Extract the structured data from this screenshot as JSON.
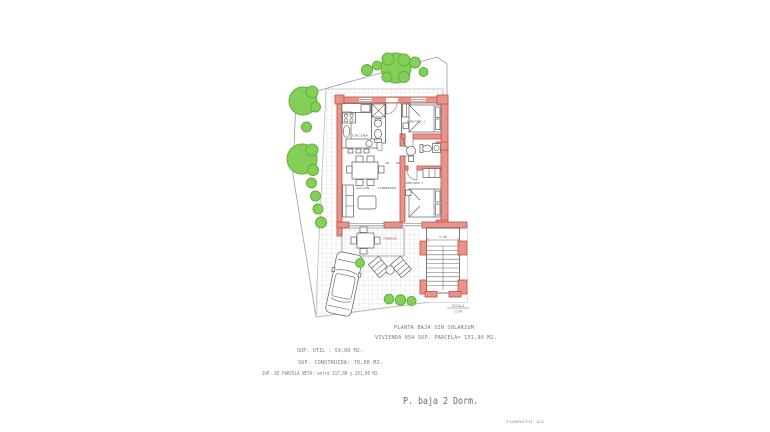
{
  "theme": {
    "wall-fill": "#e8948b",
    "wall-stroke": "#bf4f44",
    "tree-fill": "#85cf58",
    "tree-stroke": "#5fb23a",
    "grid-line": "#cfcfcf"
  },
  "annotations": {
    "title_line1": "PLANTA BAJA SIN SOLARIUM",
    "title_line2": "VIVIENDA 054 SUP. PARCELA= 151,90 M2.",
    "sup_util": "SUP. UTIL : 59,00 M2.",
    "sup_construida": "SUP. CONSTRUIDA: 70,00 M2.",
    "sup_parcela_neta": "SUP. DE PARCELA NETA: entre 117,00 y 201,00 M2.",
    "plate_label": "P. baja 2 Dorm.",
    "sheet_code": "FORMATO A3",
    "scale_label": "ESCALA",
    "scale_value": "1/50",
    "stairs_dim": "4,00"
  },
  "room_labels": {
    "kitchen": "COCINA",
    "living": "SALON - COMEDOR",
    "bedroom1": "DORMITORIO 1",
    "bedroom2": "DORMITORIO 2",
    "terrace": "TERRAZA"
  }
}
